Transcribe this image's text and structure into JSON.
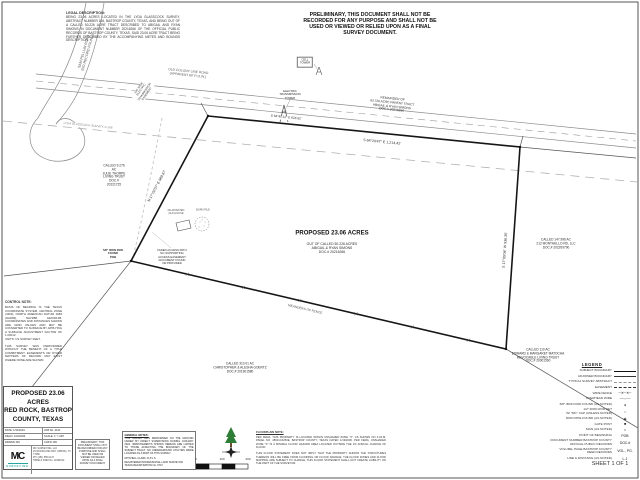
{
  "sheet": {
    "preliminary_notice": "PRELIMINARY, THIS DOCUMENT SHALL NOT BE RECORDED FOR ANY PURPOSE AND SHALL NOT BE USED OR VIEWED OR RELIED UPON AS A FINAL SURVEY DOCUMENT.",
    "sheet_number": "SHEET 1 OF 1"
  },
  "labels": [
    {
      "name": "legal-description-heading",
      "text": "LEGAL DESCRIPTION:"
    },
    {
      "name": "legal-description-text",
      "text": "BEING 23.06 ACRES LOCATED IN THE LYDA GLASSCOCK SURVEY, ABSTRACT NUMBER 166, BASTROP COUNTY, TEXAS, AND BEING OUT OF A CALLED 50.226 ACRE TRACT DESCRIBED TO ABIGAIL AND RYAN SIMONS IN DOCUMENT NUMBER 20216266 OF THE OFFICIAL PUBLIC RECORDS OF BASTROP COUNTY, TEXAS, SAID 23.06 ACRE TRACT BEING FURTHER DESCRIBED BY THE ACCOMPANYING METES AND BOUNDS DESCRIPTION."
    },
    {
      "name": "side-road-name",
      "text": "SAM PELLUM ROAD\n(NO RECORD FOUND)"
    },
    {
      "name": "main-road-name",
      "text": "OLD COLONY LINE ROAD\n(APPARENT 60' R.O.W.)"
    },
    {
      "name": "survey-abstract-label",
      "text": "LYDA GLASSCOCK SURVEY, A-166"
    },
    {
      "name": "transmission-easement-label",
      "text": "100' WIDE\nELECTRIC\nTRANSMISSION\nEASEMENT"
    },
    {
      "name": "road-bearing-label",
      "text": "S 64°45'12\" E  624.62'"
    },
    {
      "name": "north-boundary-bearing",
      "text": "S 64°20'47\" E  1,214.42'"
    },
    {
      "name": "west-boundary-bearing",
      "text": "N 17°02'07\" E  989.87'"
    },
    {
      "name": "east-boundary-bearing",
      "text": "S 17°09'04\" W  936.35'"
    },
    {
      "name": "remainder-tract-label",
      "text": "REMAINDER OF\n63.726 ACRE PARENT TRACT\nABIGAIL & RYAN SIMONS\nDOC.# 20216266"
    },
    {
      "name": "subject-tract-title",
      "text": "PROPOSED 23.06 ACRES"
    },
    {
      "name": "subject-tract-details",
      "text": "OUT OF CALLED 50.226 ACRES\nABIGAIL & RYAN SIMONS\nDOC.# 20216266"
    },
    {
      "name": "adjoiner-thorpe",
      "text": "CALLED 9.276\nAC\nJULIE THORPE\nLIVING TRUST\nDOC.#\n20221725"
    },
    {
      "name": "adjoiner-monthello",
      "text": "CALLED 147.996 AC\n212 MONTHELLO RD, LLC\nDOC.# 202209790"
    },
    {
      "name": "adjoiner-matocha",
      "text": "CALLED 110 AC\nEDWARD & MARGARET MATOCHA\nREVOCABLE LIVING TRUST\nDOC.# 20001560"
    },
    {
      "name": "adjoiner-goertz",
      "text": "CALLED 310.01 AC\nCHRISTOPHER & ALESHA GOERTZ\nDOC.# 201901580"
    },
    {
      "name": "fence-meanders-label",
      "text": "MEANDERS OF FENCE"
    },
    {
      "name": "access-path-note",
      "text": "FADED ACCESS PATH\nNO SUPPORTING\nACCESS EASEMENT\nDOCUMENT FOUND\nOR PROVIDED"
    },
    {
      "name": "pob-label",
      "text": "5/8\" IRON ROD\nFOUND\nPOB"
    },
    {
      "name": "old-house-label",
      "text": "DILAPIDATED\nOLD HOUSE"
    },
    {
      "name": "burn-pile-label",
      "text": "BURN PILE"
    },
    {
      "name": "cell-tower-label",
      "text": "CELL\nTOWER"
    },
    {
      "name": "transmission-tower-label",
      "text": "ELECTRIC\nTRANSMISSION\nTOWER"
    }
  ],
  "control_note": {
    "heading": "CONTROL NOTE:",
    "body": "BASIS OF BEARING IS THE TEXAS COORDINATE SYSTEM, CENTRAL ZONE (4203), NORTH AMERICAN DATUM 1983 (NAD83), NAVD88, GEOID12B. COORDINATES AND DISTANCES SHOWN ARE GRID VALUES AND MAY BE CONVERTED TO SURFACE BY APPLYING A SURFACE ADJUSTMENT FACTOR OF 1.00012.\nUNITS: US SURVEY FEET.\n\nTHIS SURVEY WAS PERFORMED WITHOUT THE BENEFIT OF A TITLE COMMITMENT. EASEMENTS OR OTHER MATTERS OF RECORD MAY EXIST WHERE NONE ARE SHOWN."
  },
  "title_block": {
    "project_title": "PROPOSED 23.06 ACRES\nRED ROCK, BASTROP\nCOUNTY, TEXAS",
    "rows": [
      {
        "l": "DATE: 1/31/2024",
        "r": "JOB No. 4131"
      },
      {
        "l": "FIELD: 1/24/2024",
        "r": "SCALE: 1\" = 200'"
      },
      {
        "l": "DRAWN: MC",
        "r": "CHK'D: RD"
      }
    ],
    "logo_text": "MC",
    "logo_sub": "SURVEYING",
    "firm_info": "MC SURVEYING, LLC\n26 WOODLAND WAY, SPRING, TX 77386\nPH: (281) 555-0147\nTBPELS FIRM No. 10194512"
  },
  "general_notes": {
    "heading": "GENERAL NOTES:",
    "body": "THIS SURVEY WAS PERFORMED ON THE GROUND UNDER MY DIRECT SUPERVISION DURING JANUARY 2024. IMPROVEMENTS SHOWN HEREON ARE LIMITED TO THOSE AFFECTING THE BOUNDARY OF THE SUBJECT TRACT. NO UNDERGROUND UTILITIES WERE LOCATED AS A PART OF THIS SURVEY.",
    "signer": "MITCHELL CLARK, R.P.L.S.\nREGISTERED PROFESSIONAL LAND SURVEYOR\nTEXAS REGISTRATION No. 6747"
  },
  "floodplain_note": {
    "heading": "FLOODPLAIN NOTE:",
    "body": "PER FEMA, THIS PROPERTY IS LOCATED WITHIN UNSHADED ZONE \"X\", AS SHOWN ON F.I.R.M. PANEL NO. 48021C0250E, BASTROP COUNTY, TEXAS DATED 1/19/2006. PER FEMA, UNSHADED ZONE \"X\" IS A MINIMAL FLOOD HAZARD AREA LOCATED OUTSIDE THE 1% ANNUAL CHANCE OF FLOOD.\n\nTHIS FLOOD STATEMENT DOES NOT IMPLY THAT THE PROPERTY AND/OR THE STRUCTURES THEREON WILL BE FREE FROM FLOODING OR FLOOD DAMAGE. THE FLOOD ZONES AND FLOOD MAPPING ARE SUBJECT TO CHANGE. THIS FLOOD STATEMENT SHALL NOT CREATE LIABILITY ON THE PART OF THE SURVEYOR."
  },
  "scale_bar": {
    "ticks": [
      "0",
      "100",
      "200"
    ]
  },
  "legend": {
    "title": "LEGEND",
    "items": [
      {
        "label": "SUBJECT BOUNDARY",
        "symbol": ""
      },
      {
        "label": "ADJOINER BOUNDARY",
        "symbol": ""
      },
      {
        "label": "TYPICAL SURVEY ABSTRACT",
        "symbol": ""
      },
      {
        "label": "EASEMENT",
        "symbol": ""
      },
      {
        "label": "WIRE FENCE",
        "symbol": "─✕─✕─"
      },
      {
        "label": "OVERHEAD WIRE",
        "symbol": "──◦──"
      },
      {
        "label": "5/8\" IRON ROD FOUND (AS NOTED)",
        "symbol": "●"
      },
      {
        "label": "1/2\" IRON ROD SET\nW/ \"MC\" CAP (UNLESS NOTED)",
        "symbol": "○"
      },
      {
        "label": "IRON PIPE FOUND (AS NOTED)",
        "symbol": "◉"
      },
      {
        "label": "GATE POST",
        "symbol": "■"
      },
      {
        "label": "SIGN (AS NOTED)",
        "symbol": "□"
      },
      {
        "label": "POINT OF BEGINNING",
        "symbol": "POB"
      },
      {
        "label": "DOCUMENT NUMBER BASTROP COUNTY\nOFFICIAL PUBLIC RECORDS",
        "symbol": "DOC.#"
      },
      {
        "label": "VOLUME, PAGE BASTROP COUNTY\nDEED RECORDS",
        "symbol": "VOL., PG."
      },
      {
        "label": "LINE & DISTANCE (AS NOTED)",
        "symbol": "L-1"
      }
    ]
  },
  "colors": {
    "logo_accent": "#23a79f",
    "tree_green": "#2e7d36",
    "line_gray": "#8a8a8a"
  }
}
